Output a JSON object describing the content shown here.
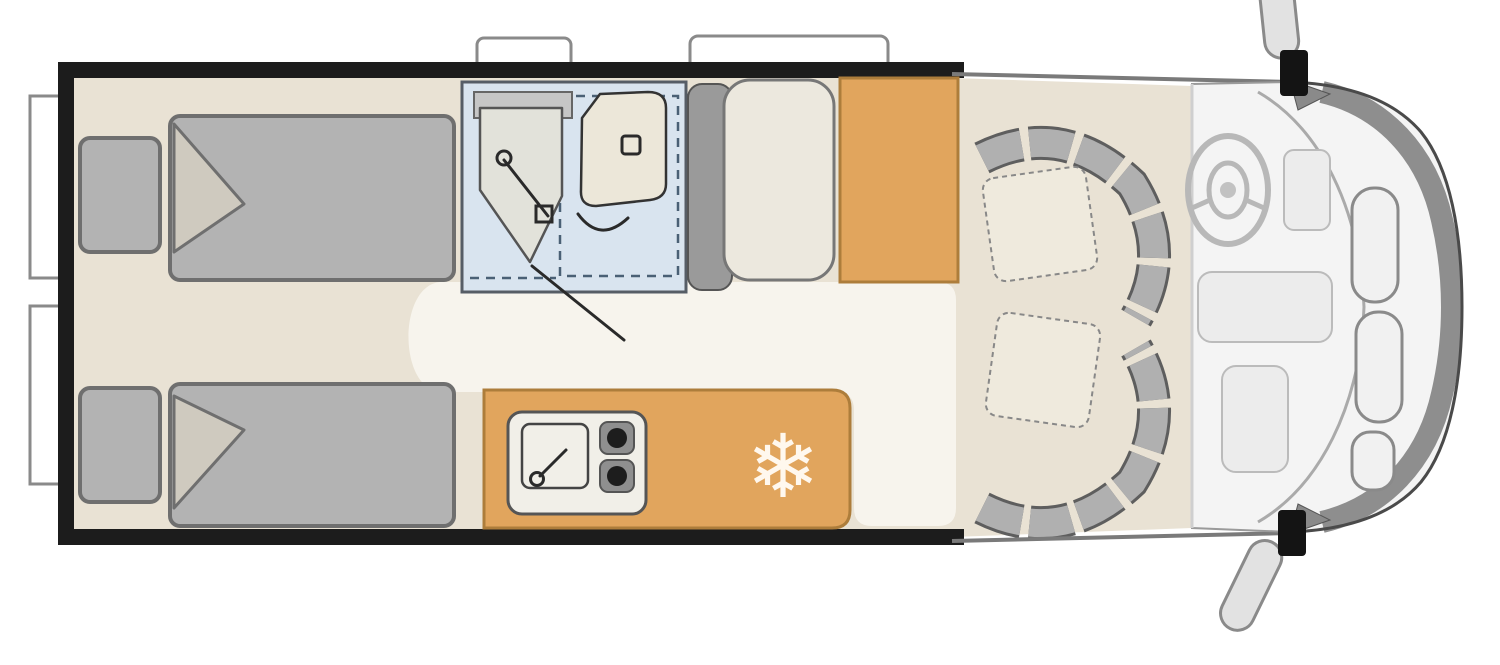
{
  "diagram": {
    "type": "motorhome-floor-plan",
    "view": "top-down",
    "orientation": "cab-on-right"
  },
  "kitchen": {
    "fridge_icon_glyph": "❄"
  },
  "colors": {
    "background": "#ffffff",
    "wall": "#1c1c1c",
    "floor": "#e9e2d4",
    "walkway": "#f7f4ed",
    "furniture_gray": "#b3b3b3",
    "furniture_gray_dark": "#9a9a9a",
    "bathroom_blue": "#d9e4ef",
    "wood_orange": "#e1a55d",
    "wood_orange_border": "#ad7d3b",
    "seat_cushion": "#efeadd",
    "cream": "#ece7d9",
    "cab_white": "#f4f4f4",
    "front_band": "#8e8e8e",
    "mirror_gray": "#e2e2e2"
  }
}
